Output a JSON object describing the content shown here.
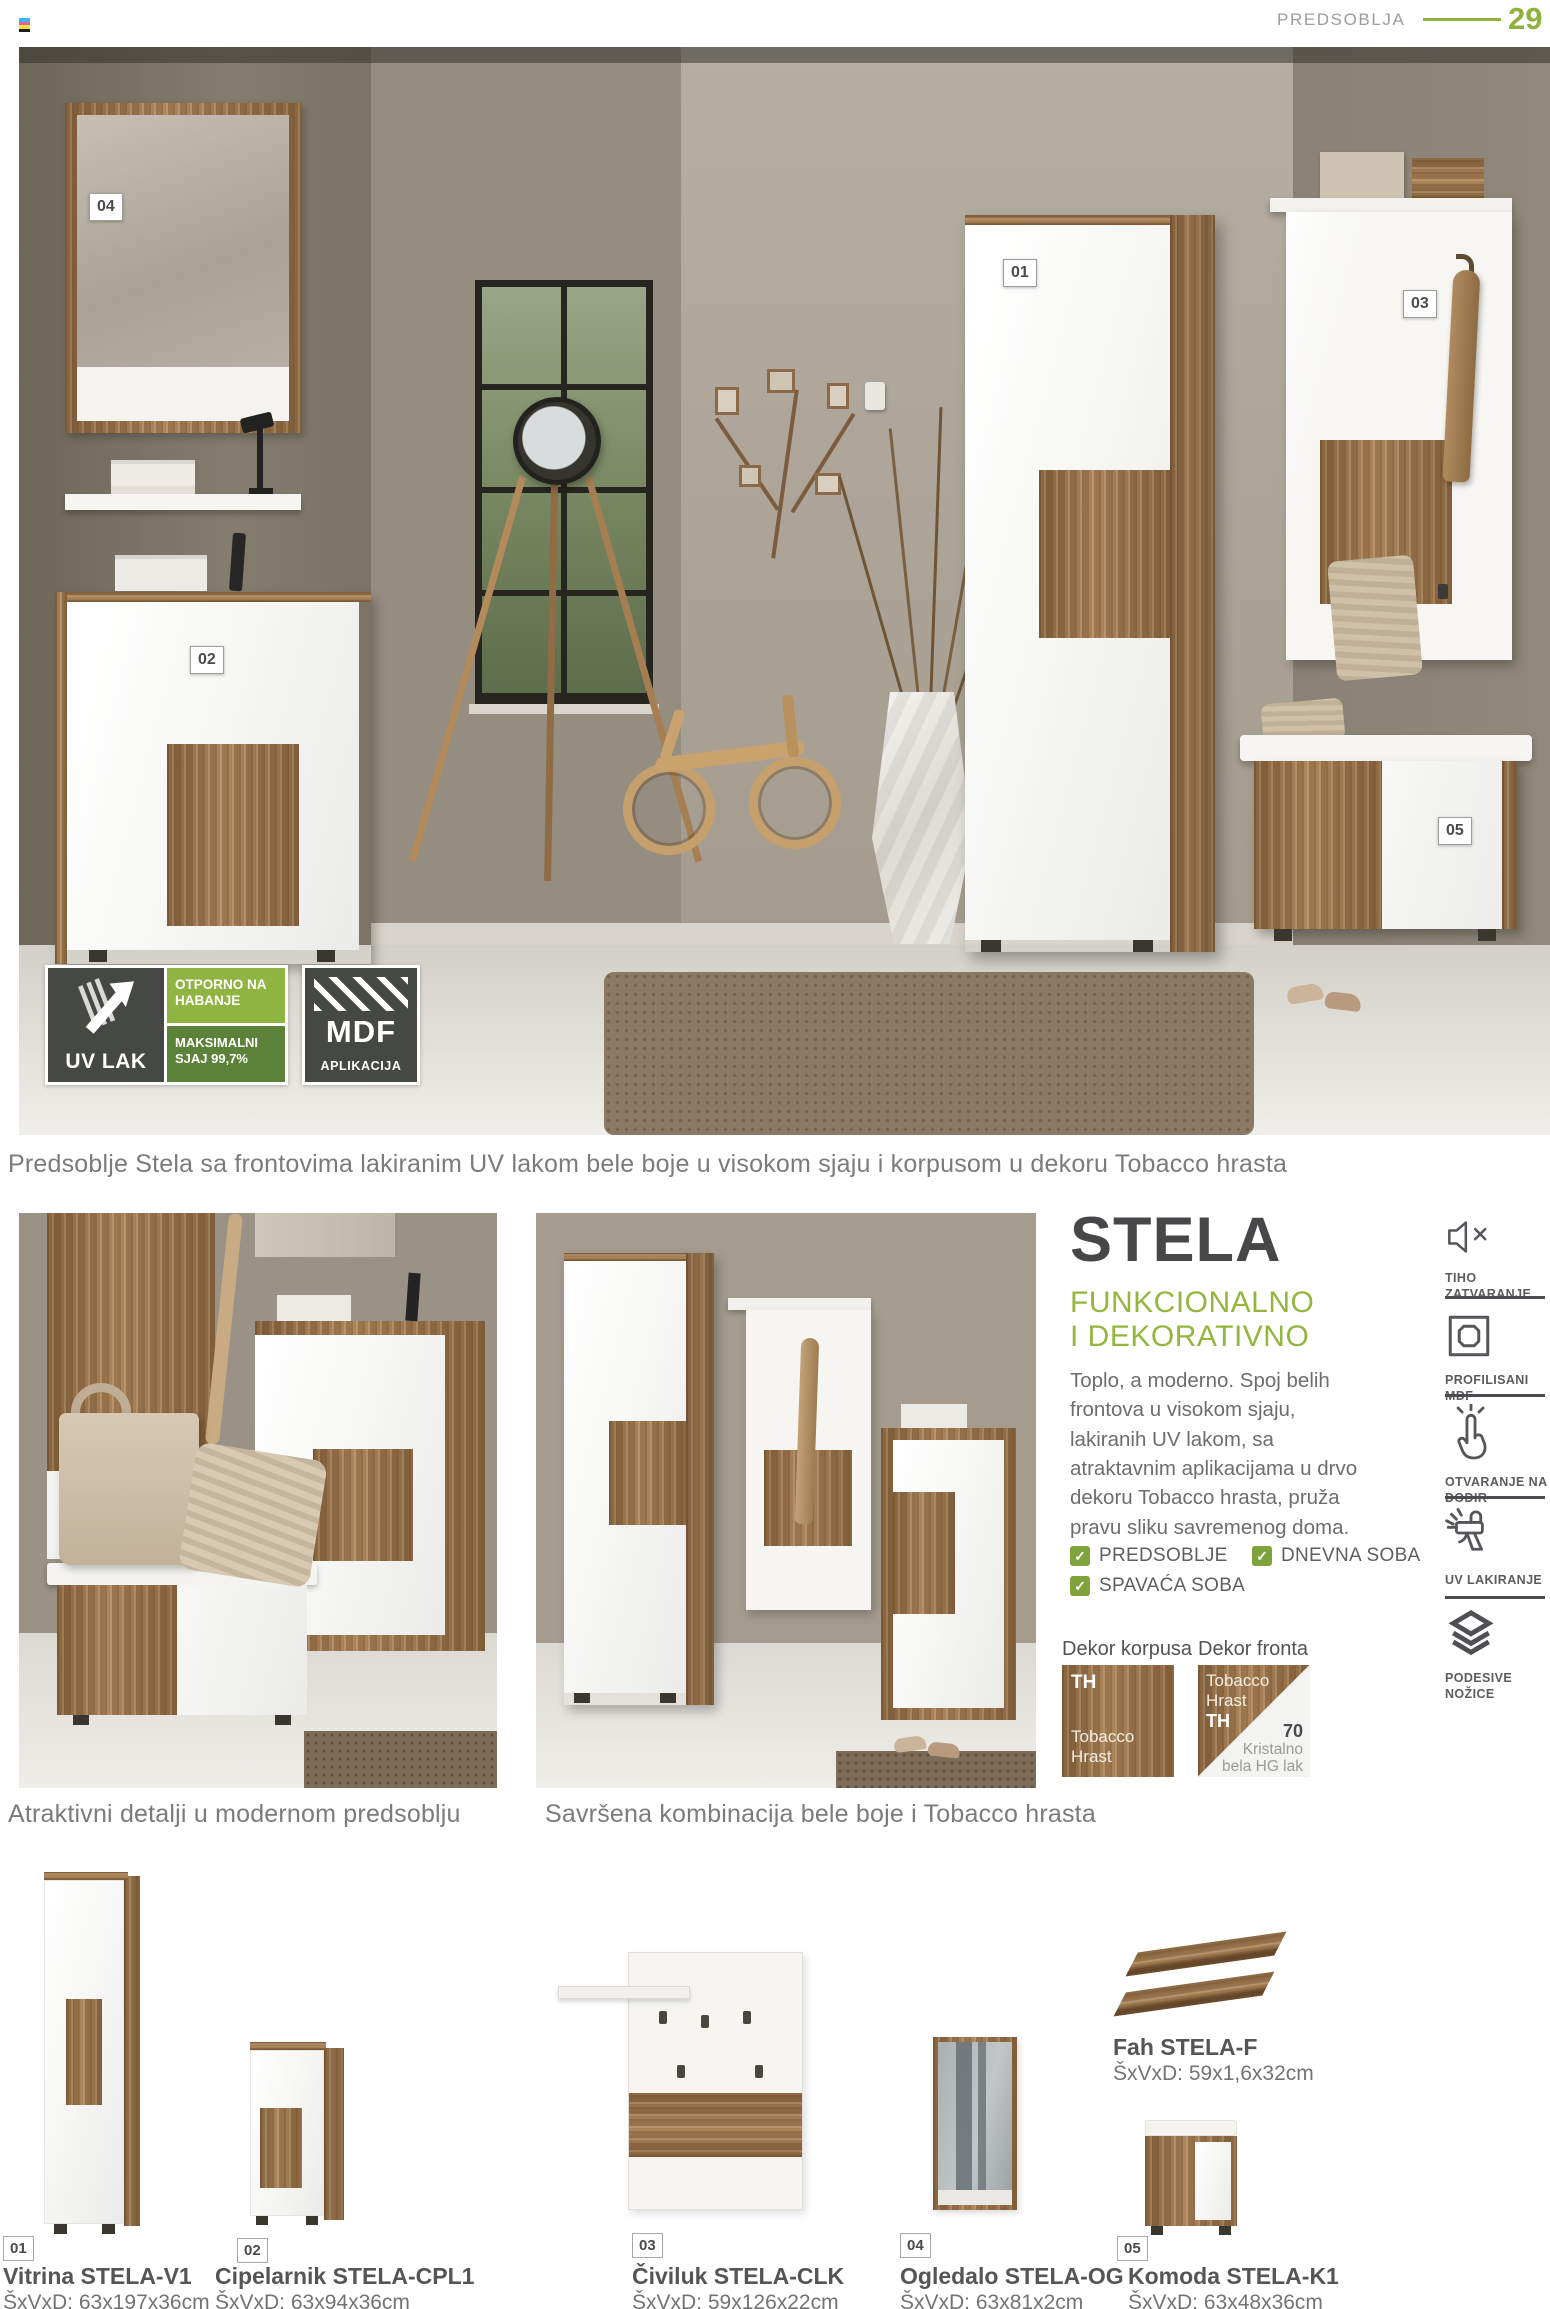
{
  "header": {
    "section": "PREDSOBLJA",
    "page_number": "29"
  },
  "hero": {
    "tags": [
      "01",
      "02",
      "03",
      "04",
      "05"
    ],
    "badge_uv": {
      "title": "UV LAK",
      "box1": "OTPORNO NA HABANJE",
      "box2": "MAKSIMALNI SJAJ 99,7%"
    },
    "badge_mdf": {
      "big": "MDF",
      "small": "APLIKACIJA"
    },
    "caption": "Predsoblje Stela sa frontovima lakiranim UV lakom bele boje u visokom sjaju i korpusom u dekoru Tobacco hrasta"
  },
  "gallery": {
    "caption_left": "Atraktivni detalji u modernom predsoblju",
    "caption_right": "Savršena kombinacija bele boje i Tobacco hrasta"
  },
  "info": {
    "title": "STELA",
    "subtitle_line1": "FUNKCIONALNO",
    "subtitle_line2": "I DEKORATIVNO",
    "description": "Toplo, a moderno. Spoj belih frontova u visokom sjaju, lakiranih UV lakom, sa atraktavnim aplikacijama u drvo dekoru Tobacco hrasta, pruža pravu sliku savremenog doma.",
    "rooms": [
      "PREDSOBLJE",
      "SPAVAĆA SOBA",
      "DNEVNA SOBA"
    ],
    "dekor_korpusa_heading": "Dekor korpusa",
    "dekor_fronta_heading": "Dekor fronta",
    "korpus_code": "TH",
    "korpus_name": "Tobacco Hrast",
    "front_top_name": "Tobacco Hrast",
    "front_top_code": "TH",
    "front_bottom_code": "70",
    "front_bottom_name": "Kristalno bela HG lak"
  },
  "features": [
    {
      "name": "silent-closing",
      "label": "TIHO ZATVARANJE"
    },
    {
      "name": "profiled-mdf",
      "label": "PROFILISANI MDF"
    },
    {
      "name": "touch-opening",
      "label": "OTVARANJE NA DODIR"
    },
    {
      "name": "uv-lacquering",
      "label": "UV LAKIRANJE"
    },
    {
      "name": "adjustable-feet",
      "label": "PODESIVE NOŽICE"
    }
  ],
  "products": [
    {
      "num": "01",
      "name": "Vitrina STELA-V1",
      "dims": "ŠxVxD: 63x197x36cm"
    },
    {
      "num": "02",
      "name": "Cipelarnik STELA-CPL1",
      "dims": "ŠxVxD: 63x94x36cm"
    },
    {
      "num": "03",
      "name": "Čiviluk STELA-CLK",
      "dims": "ŠxVxD: 59x126x22cm"
    },
    {
      "num": "04",
      "name": "Ogledalo STELA-OG",
      "dims": "ŠxVxD: 63x81x2cm"
    },
    {
      "num": "05",
      "name": "Komoda STELA-K1",
      "dims": "ŠxVxD: 63x48x36cm"
    }
  ],
  "shelf_product": {
    "name": "Fah STELA-F",
    "dims": "ŠxVxD: 59x1,6x32cm"
  },
  "colors": {
    "accent_green": "#8fb23c",
    "checkbox_green": "#7fa33c",
    "badge_green_light": "#8fb441",
    "badge_green_dark": "#5c8138",
    "badge_charcoal": "#454843",
    "wood": "#a37d52"
  }
}
